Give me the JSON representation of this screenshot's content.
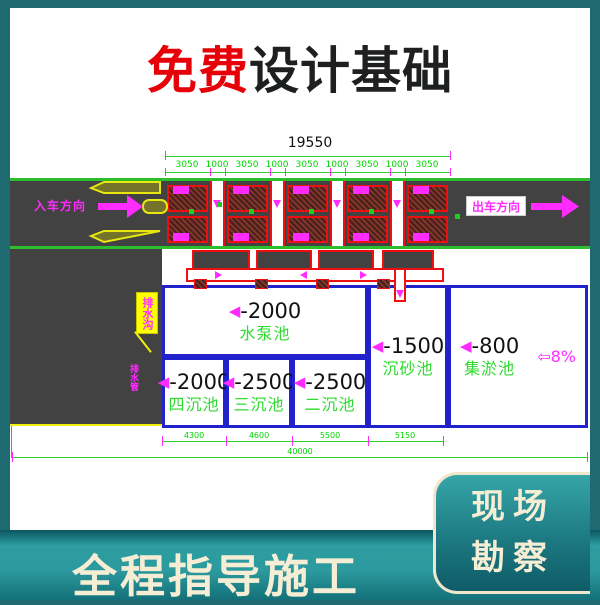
{
  "title": {
    "highlight": "免费",
    "rest": "设计基础"
  },
  "footer": {
    "banner_text": "全程指导施工",
    "card_line1": "现场",
    "card_line2": "勘察"
  },
  "plan": {
    "overall_top": "19550",
    "top_dims": [
      "3050",
      "1000",
      "3050",
      "1000",
      "3050",
      "1000",
      "3050",
      "1000",
      "3050"
    ],
    "entry_label": "入车方向",
    "exit_label": "出车方向",
    "callout_label": "排水沟",
    "callout_note": "排水管",
    "tri": "◀",
    "slope_arrow": "⇦",
    "slope_value": "8%",
    "tanks": [
      {
        "depth": "-2000",
        "name": "水泵池"
      },
      {
        "depth": "-2000",
        "name": "四沉池"
      },
      {
        "depth": "-2500",
        "name": "三沉池"
      },
      {
        "depth": "-2500",
        "name": "二沉池"
      },
      {
        "depth": "-1500",
        "name": "沉砂池"
      },
      {
        "depth": "-800",
        "name": "集淤池"
      }
    ],
    "bottom_dims": [
      "4300",
      "4600",
      "5500",
      "5150"
    ],
    "overall_bottom": "40000"
  },
  "colors": {
    "frame_teal": "#1e6a70",
    "banner_teal": "#2d9da0",
    "cream": "#f6edd5",
    "title_red": "#e60008",
    "title_dark": "#1e2020",
    "road_gray": "#424242",
    "road_green": "#2dbe2d",
    "dim_green": "#00d400",
    "magenta": "#ff2bff",
    "tank_blue": "#2222cc",
    "grid_red": "#ee1010",
    "yellow": "#f0f00c",
    "pool_green": "#2edb2e"
  }
}
